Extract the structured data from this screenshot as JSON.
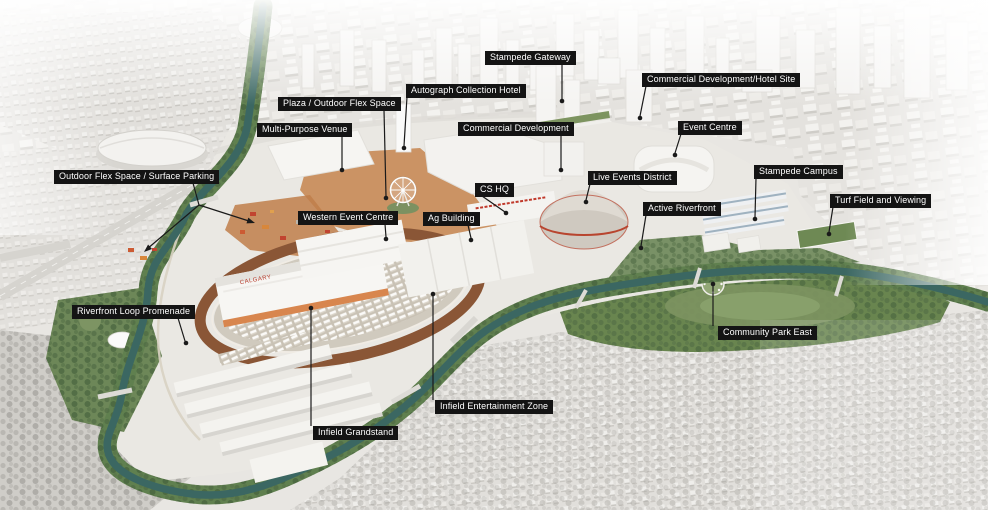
{
  "palette": {
    "label_bg": "#141414",
    "label_fg": "#ffffff",
    "leader": "#1a1a1a",
    "river": "#3b6762",
    "greenery": "#60804f",
    "midway": "#c88a55",
    "track": "#8a5636",
    "building": "#f5f4f1",
    "city": "#e4e2de",
    "accent_red": "#b73a2a"
  },
  "signage": {
    "grandstand_left": "CALGARY",
    "grandstand_right": "STAMPEDE"
  },
  "callouts": [
    {
      "label": "Stampede Gateway",
      "box": [
        485,
        51
      ],
      "lines": [
        [
          562,
          64,
          562,
          99
        ]
      ],
      "points": [
        [
          562,
          101,
          "dot"
        ]
      ]
    },
    {
      "label": "Autograph Collection Hotel",
      "box": [
        406,
        84
      ],
      "lines": [
        [
          407,
          97,
          404,
          146
        ]
      ],
      "points": [
        [
          404,
          148,
          "dot"
        ]
      ]
    },
    {
      "label": "Plaza / Outdoor Flex Space",
      "box": [
        278,
        97
      ],
      "lines": [
        [
          384,
          110,
          386,
          196
        ]
      ],
      "points": [
        [
          386,
          198,
          "dot"
        ]
      ]
    },
    {
      "label": "Multi-Purpose Venue",
      "box": [
        257,
        123
      ],
      "lines": [
        [
          342,
          136,
          342,
          168
        ]
      ],
      "points": [
        [
          342,
          170,
          "dot"
        ]
      ]
    },
    {
      "label": "Commercial Development",
      "box": [
        458,
        122
      ],
      "lines": [
        [
          561,
          135,
          561,
          168
        ]
      ],
      "points": [
        [
          561,
          170,
          "dot"
        ]
      ]
    },
    {
      "label": "Commercial Development/Hotel Site",
      "box": [
        642,
        73
      ],
      "lines": [
        [
          646,
          86,
          640,
          116
        ]
      ],
      "points": [
        [
          640,
          118,
          "dot"
        ]
      ]
    },
    {
      "label": "Event Centre",
      "box": [
        678,
        121
      ],
      "lines": [
        [
          681,
          134,
          675,
          153
        ]
      ],
      "points": [
        [
          675,
          155,
          "dot"
        ]
      ]
    },
    {
      "label": "CS HQ",
      "box": [
        475,
        183
      ],
      "lines": [
        [
          482,
          196,
          505,
          212
        ]
      ],
      "points": [
        [
          506,
          213,
          "dot"
        ]
      ]
    },
    {
      "label": "Live Events District",
      "box": [
        588,
        171
      ],
      "lines": [
        [
          590,
          184,
          586,
          200
        ]
      ],
      "points": [
        [
          586,
          202,
          "dot"
        ]
      ]
    },
    {
      "label": "Stampede Campus",
      "box": [
        754,
        165
      ],
      "lines": [
        [
          756,
          178,
          755,
          217
        ]
      ],
      "points": [
        [
          755,
          219,
          "dot"
        ]
      ]
    },
    {
      "label": "Turf Field and Viewing",
      "box": [
        830,
        194
      ],
      "lines": [
        [
          833,
          207,
          829,
          232
        ]
      ],
      "points": [
        [
          829,
          234,
          "dot"
        ]
      ]
    },
    {
      "label": "Active Riverfront",
      "box": [
        643,
        202
      ],
      "lines": [
        [
          646,
          215,
          641,
          246
        ]
      ],
      "points": [
        [
          641,
          248,
          "dot"
        ]
      ]
    },
    {
      "label": "Western Event Centre",
      "box": [
        298,
        211
      ],
      "lines": [
        [
          385,
          224,
          386,
          237
        ]
      ],
      "points": [
        [
          386,
          239,
          "dot"
        ]
      ]
    },
    {
      "label": "Ag Building",
      "box": [
        423,
        212
      ],
      "lines": [
        [
          468,
          225,
          471,
          238
        ]
      ],
      "points": [
        [
          471,
          240,
          "dot"
        ]
      ]
    },
    {
      "label": "Outdoor Flex Space / Surface Parking",
      "box": [
        54,
        170
      ],
      "lines": [
        [
          193,
          183,
          199,
          205
        ],
        [
          199,
          205,
          147,
          249
        ],
        [
          199,
          205,
          252,
          222
        ]
      ],
      "points": [
        [
          144,
          252,
          "arrow",
          139
        ],
        [
          255,
          223,
          "arrow",
          18
        ]
      ]
    },
    {
      "label": "Riverfront Loop Promenade",
      "box": [
        72,
        305
      ],
      "lines": [
        [
          178,
          318,
          185,
          341
        ]
      ],
      "points": [
        [
          186,
          343,
          "dot"
        ]
      ]
    },
    {
      "label": "Infield Grandstand",
      "box": [
        313,
        426
      ],
      "lines": [
        [
          311,
          426,
          311,
          310
        ]
      ],
      "points": [
        [
          311,
          308,
          "dot"
        ]
      ]
    },
    {
      "label": "Infield Entertainment Zone",
      "box": [
        435,
        400
      ],
      "lines": [
        [
          433,
          400,
          433,
          296
        ]
      ],
      "points": [
        [
          433,
          294,
          "dot"
        ]
      ]
    },
    {
      "label": "Community Park East",
      "box": [
        718,
        326
      ],
      "lines": [
        [
          713,
          326,
          713,
          286
        ]
      ],
      "points": [
        [
          713,
          284,
          "dot"
        ]
      ]
    }
  ]
}
